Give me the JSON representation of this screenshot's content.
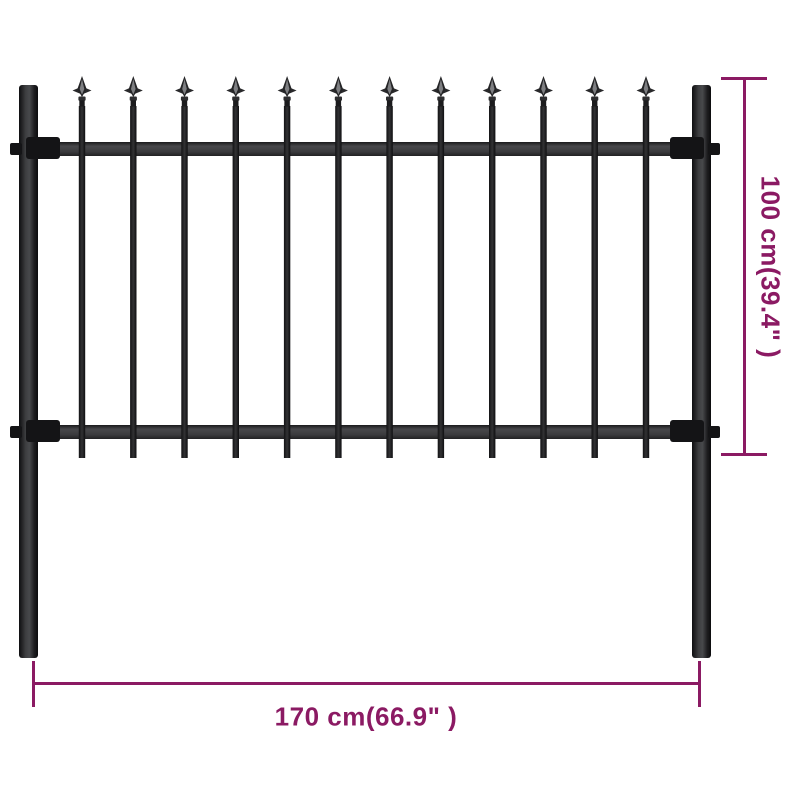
{
  "product": {
    "title": "Steel garden fence panel with spear top",
    "colors": {
      "accent": "#8B1A63",
      "fence_black": "#1b1b1d",
      "rail_gray": "#3e3e40",
      "background": "#ffffff"
    },
    "fence": {
      "picket_count": 12,
      "post_count": 2,
      "rail_count": 2
    }
  },
  "annotations": {
    "height": {
      "label": "100 cm(39.4\" )"
    },
    "width": {
      "label": "170 cm(66.9\" )"
    }
  }
}
